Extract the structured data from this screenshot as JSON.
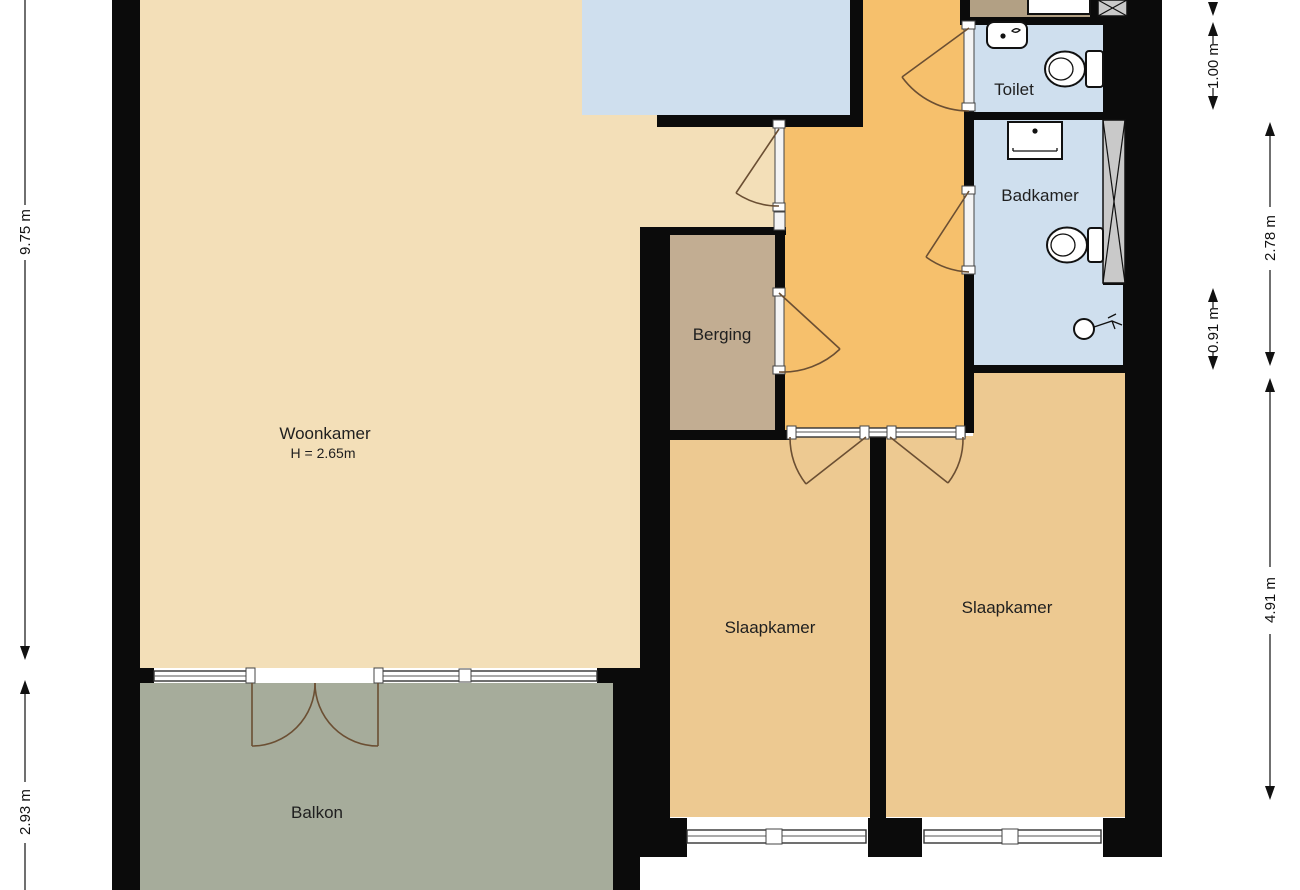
{
  "rooms": {
    "woonkamer": {
      "label": "Woonkamer",
      "height_note": "H = 2.65m"
    },
    "berging": {
      "label": "Berging"
    },
    "toilet": {
      "label": "Toilet"
    },
    "badkamer": {
      "label": "Badkamer"
    },
    "slaapkamer_left": {
      "label": "Slaapkamer"
    },
    "slaapkamer_right": {
      "label": "Slaapkamer"
    },
    "balkon": {
      "label": "Balkon"
    }
  },
  "dimensions": {
    "left_total": "9.75 m",
    "left_balcony": "2.93 m",
    "right_toilet": "1.00 m",
    "right_badkamer": "2.78 m",
    "right_badkamer_low": "0.91 m",
    "right_bedroom": "4.91 m"
  },
  "colors": {
    "living": "#f3dfb8",
    "bedroom": "#edc991",
    "hall": "#f6c06c",
    "storage": "#c2ad92",
    "wet_room": "#cfdfee",
    "balcony": "#a6ac9b",
    "annex": "#b2a084",
    "wall": "#0b0b0b"
  },
  "icons": {
    "toilet-icon": "oval bowl with cistern",
    "sink-icon": "rectangle with drain dot",
    "bath-tap-icon": "circle with spout",
    "kitchen-counter-icon": "outlined rectangle",
    "duct-hatch-icon": "grey rectangle with cross lines",
    "door-swing-icon": "leaf line with quarter arc",
    "window-icon": "double-line band"
  }
}
